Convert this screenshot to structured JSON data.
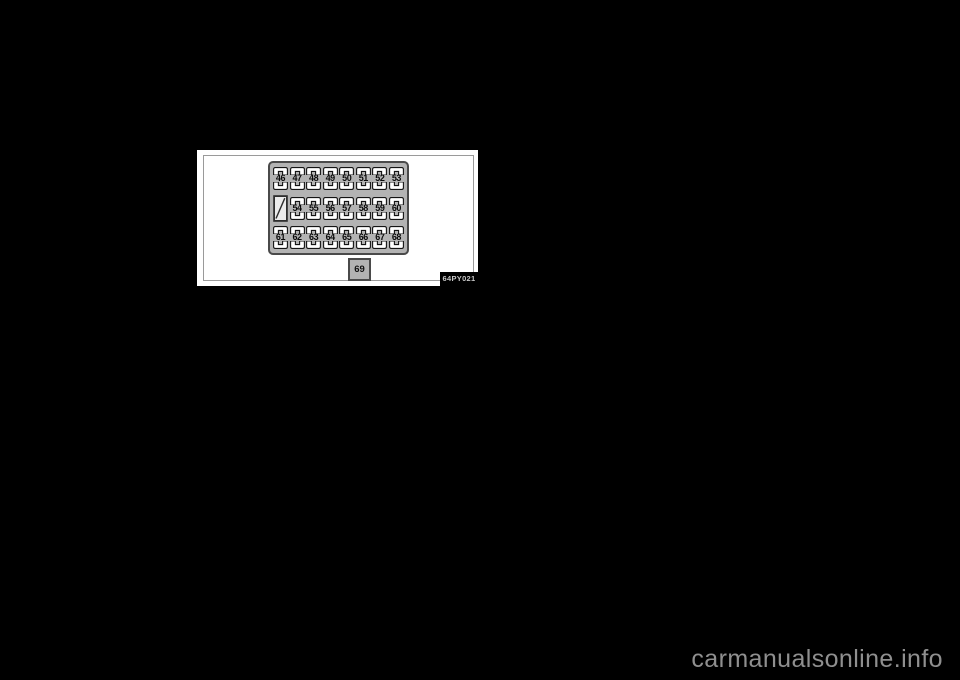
{
  "figure": {
    "code": "64PY021",
    "fuse_panel": {
      "rows": [
        {
          "cells": [
            {
              "type": "fuse",
              "label": "46"
            },
            {
              "type": "fuse",
              "label": "47"
            },
            {
              "type": "fuse",
              "label": "48"
            },
            {
              "type": "fuse",
              "label": "49"
            },
            {
              "type": "fuse",
              "label": "50"
            },
            {
              "type": "fuse",
              "label": "51"
            },
            {
              "type": "fuse",
              "label": "52"
            },
            {
              "type": "fuse",
              "label": "53"
            }
          ]
        },
        {
          "cells": [
            {
              "type": "empty-slot",
              "label": ""
            },
            {
              "type": "fuse",
              "label": "54"
            },
            {
              "type": "fuse",
              "label": "55"
            },
            {
              "type": "fuse",
              "label": "56"
            },
            {
              "type": "fuse",
              "label": "57"
            },
            {
              "type": "fuse",
              "label": "58"
            },
            {
              "type": "fuse",
              "label": "59"
            },
            {
              "type": "fuse",
              "label": "60"
            }
          ]
        },
        {
          "cells": [
            {
              "type": "fuse",
              "label": "61"
            },
            {
              "type": "fuse",
              "label": "62"
            },
            {
              "type": "fuse",
              "label": "63"
            },
            {
              "type": "fuse",
              "label": "64"
            },
            {
              "type": "fuse",
              "label": "65"
            },
            {
              "type": "fuse",
              "label": "66"
            },
            {
              "type": "fuse",
              "label": "67"
            },
            {
              "type": "fuse",
              "label": "68"
            }
          ]
        }
      ]
    },
    "standalone_fuse": {
      "label": "69"
    }
  },
  "watermark": {
    "text": "carmanualsonline.info"
  },
  "colors": {
    "page_background": "#000000",
    "figure_background": "#ffffff",
    "panel_fill": "#b3b3b3",
    "panel_border": "#4a4a4a",
    "fuse_fill": "#ffffff",
    "fuse_outline": "#141414",
    "code_badge_background": "#000000",
    "code_badge_text": "#c9c9c9",
    "watermark_text": "#8f8f8f"
  }
}
